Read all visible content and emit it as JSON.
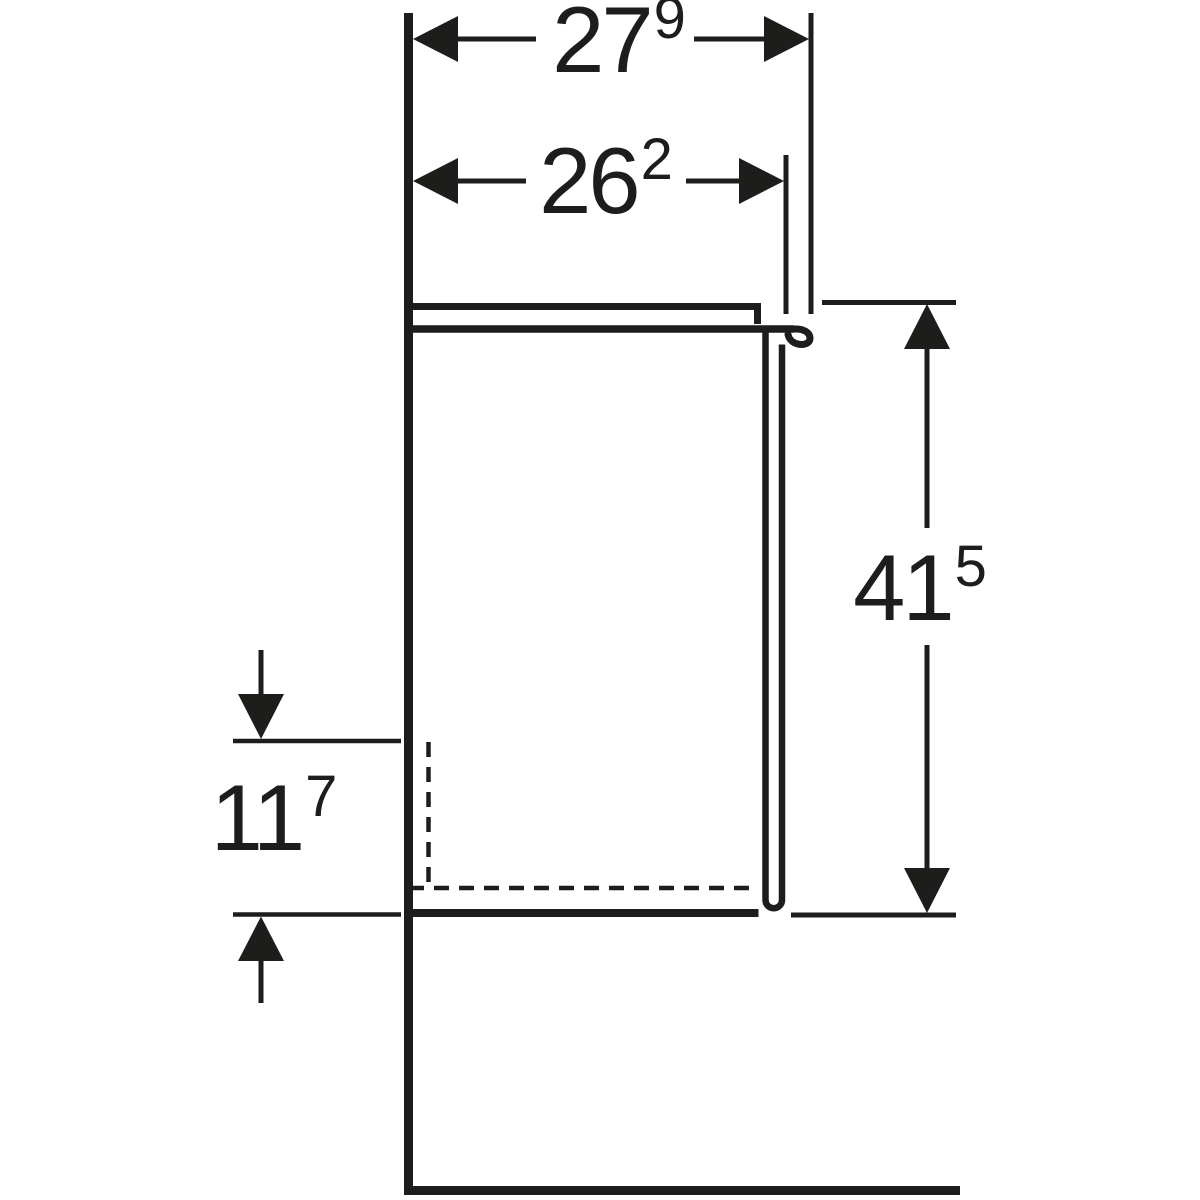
{
  "colors": {
    "ink": "#1d1d1b",
    "paper": "#ffffff"
  },
  "drawing": {
    "kind": "furniture-side-view-dimension-drawing",
    "dimensions": {
      "overall_depth": {
        "whole": "27",
        "sup": "9"
      },
      "body_depth": {
        "whole": "26",
        "sup": "2"
      },
      "overall_height": {
        "whole": "41",
        "sup": "5"
      },
      "recess_height": {
        "whole": "11",
        "sup": "7"
      }
    }
  }
}
